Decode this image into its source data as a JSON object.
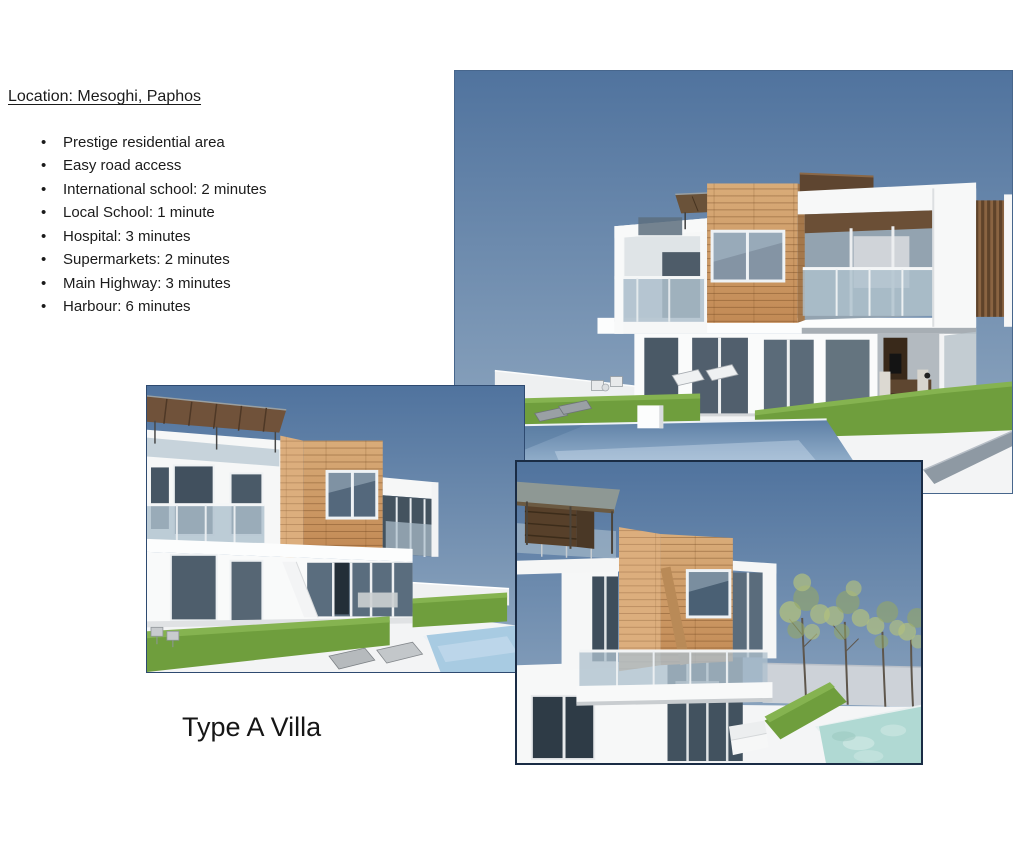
{
  "page": {
    "background": "#ffffff"
  },
  "location_section": {
    "heading": "Location: Mesoghi, Paphos",
    "bullets": [
      "Prestige residential area",
      "Easy road access",
      "International school: 2 minutes",
      "Local School: 1 minute",
      "Hospital: 3 minutes",
      "Supermarkets: 2 minutes",
      "Main Highway: 3 minutes",
      "Harbour: 6 minutes"
    ]
  },
  "caption": "Type A Villa",
  "colors": {
    "text": "#1b1b1b",
    "sky_top": "#50739e",
    "sky_bottom": "#95acc3",
    "wood_light": "#d9ac79",
    "wood_mid": "#c28a55",
    "wood_dark": "#a5784b",
    "hedge_green": "#6f9e3d",
    "hedge_light": "#85b350",
    "pool_steel": "#5e80a6",
    "pool_cyan": "#b0d9d3",
    "glass_blue": "#aec0cd",
    "window_dark": "#4a5966",
    "pergola_brown": "#6a4f33"
  }
}
